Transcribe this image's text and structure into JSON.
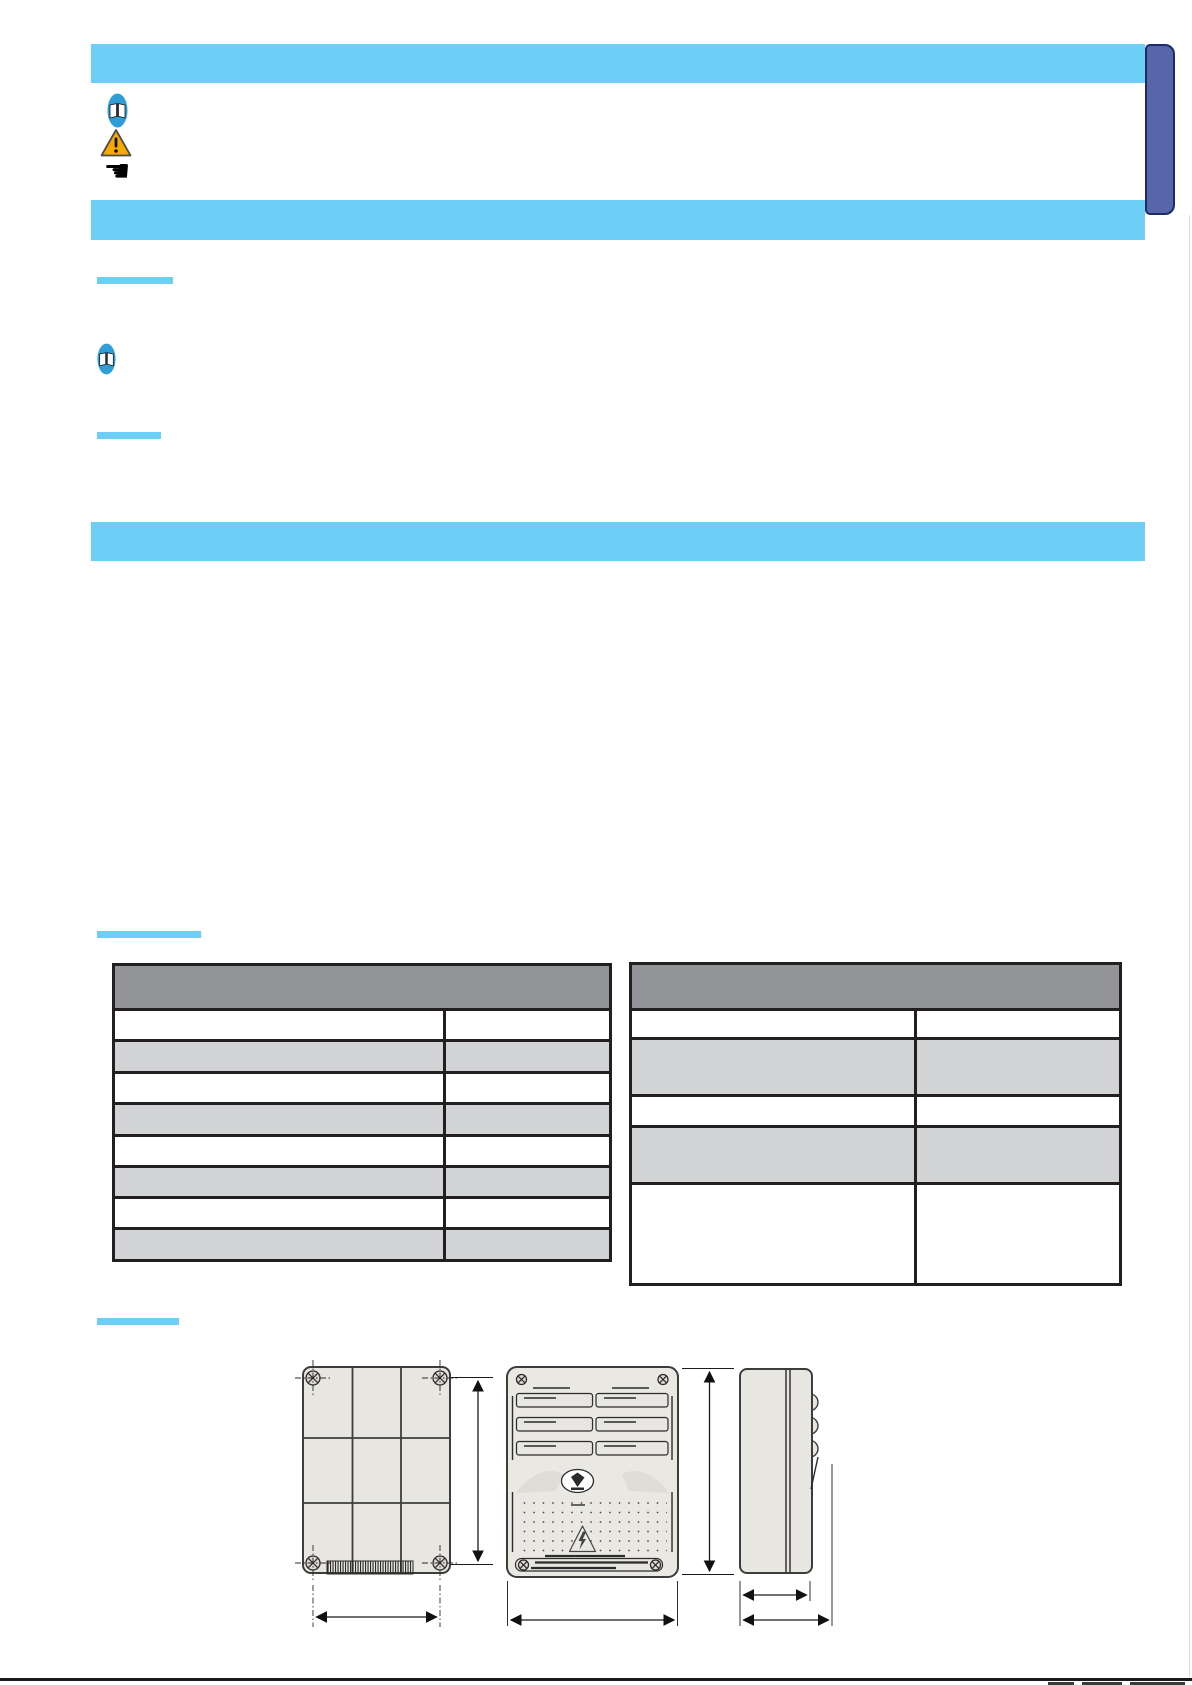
{
  "page": {
    "width": 1192,
    "height": 1685
  },
  "colors": {
    "page_bg": "#ffffff",
    "sky": "#6dcff6",
    "tab_fill": "#5766a9",
    "tab_border": "#1d2b67",
    "header_gray": "#929497",
    "stripe_gray": "#d1d3d4",
    "table_border": "#231f20",
    "draw_fill": "#e8e6e1",
    "draw_stroke": "#3d3d3c",
    "book_blue": "#2e9ed9",
    "warn_yellow": "#f7ab00",
    "ink": "#1a1a1a"
  },
  "banner": {
    "bar_count": 3,
    "note": "title text not rendered in scan (blank)"
  },
  "side_tab": {
    "label": ""
  },
  "notice_icons": [
    {
      "name": "open-book-icon"
    },
    {
      "name": "warning-triangle-icon"
    },
    {
      "name": "pointing-hand-icon"
    },
    {
      "name": "open-book-icon-small"
    }
  ],
  "icons": {
    "hand_glyph": "☛"
  },
  "section_underline_count": 4,
  "tables": {
    "left": {
      "x": 112,
      "y": 963,
      "width": 500,
      "header_height": 42,
      "col_split_pct": 67,
      "rows": [
        {
          "height": 31,
          "shade": "white"
        },
        {
          "height": 32,
          "shade": "gray"
        },
        {
          "height": 31,
          "shade": "white"
        },
        {
          "height": 32,
          "shade": "gray"
        },
        {
          "height": 31,
          "shade": "white"
        },
        {
          "height": 31,
          "shade": "gray"
        },
        {
          "height": 31,
          "shade": "white"
        },
        {
          "height": 32,
          "shade": "gray"
        }
      ]
    },
    "right": {
      "x": 629,
      "y": 962,
      "width": 493,
      "header_height": 43,
      "col_split_pct": 58.6,
      "rows": [
        {
          "height": 29,
          "shade": "white"
        },
        {
          "height": 57,
          "shade": "gray"
        },
        {
          "height": 31,
          "shade": "white"
        },
        {
          "height": 57,
          "shade": "gray"
        },
        {
          "height": 101,
          "shade": "white"
        }
      ]
    }
  },
  "drawings": {
    "views": [
      "back-view",
      "front-view",
      "side-view"
    ],
    "dimension_labels": []
  }
}
